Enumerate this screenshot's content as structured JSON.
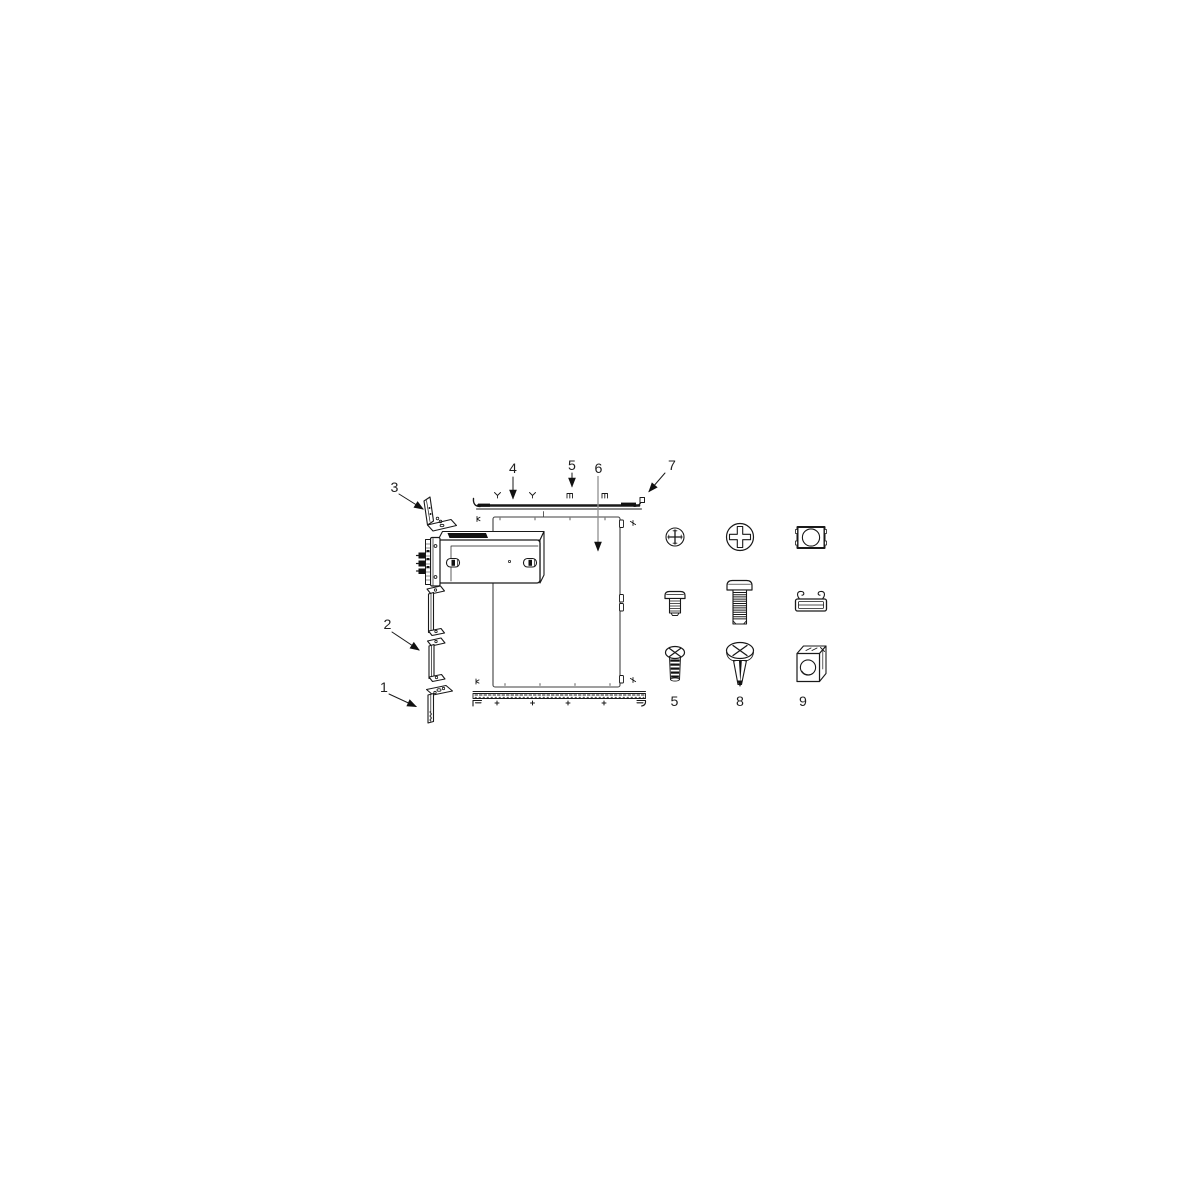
{
  "page": {
    "background": "#ffffff"
  },
  "diagram": {
    "name": "rack-mounting-kit-exploded-view",
    "colors": {
      "background": "#ffffff",
      "line": "#1a1a1a",
      "panel_line": "#3f3f3f",
      "leader_gray": "#909090",
      "dark_fill": "#111111",
      "text": "#1f1f1f"
    },
    "callouts": [
      {
        "label": "1",
        "target": "bottom-bracket-strip"
      },
      {
        "label": "2",
        "target": "middle-bracket-strip"
      },
      {
        "label": "3",
        "target": "top-angle-bracket"
      },
      {
        "label": "4",
        "target": "top-rail"
      },
      {
        "label": "5",
        "target": "top-rail-screw-position"
      },
      {
        "label": "6",
        "target": "side-panel"
      },
      {
        "label": "7",
        "target": "top-rail-end-tab"
      }
    ],
    "legend": {
      "items": [
        {
          "label": "5",
          "name": "pan-head-phillips-screw"
        },
        {
          "label": "8",
          "name": "large-pan-head-phillips-screw"
        },
        {
          "label": "9",
          "name": "cage-nut"
        }
      ]
    }
  }
}
